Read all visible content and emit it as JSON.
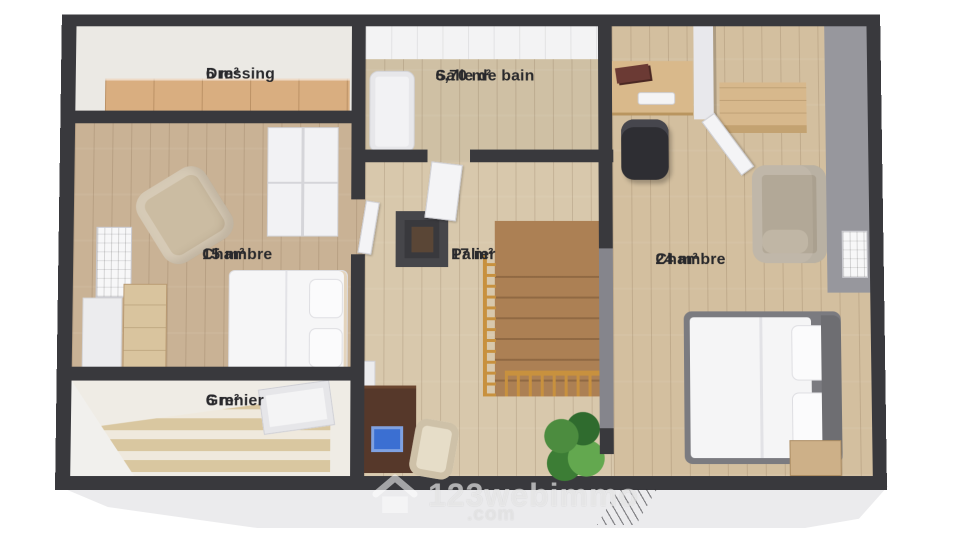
{
  "plan": {
    "rooms": [
      {
        "id": "dressing",
        "name": "Dressing",
        "area": "6 m²"
      },
      {
        "id": "salle-de-bain",
        "name": "Salle de bain",
        "area": "6,70 m²"
      },
      {
        "id": "chambre-15",
        "name": "Chambre",
        "area": "15 m²"
      },
      {
        "id": "palier",
        "name": "Palier",
        "area": "17 m²"
      },
      {
        "id": "chambre-24",
        "name": "Chambre",
        "area": "24 m²"
      },
      {
        "id": "grenier",
        "name": "Grenier",
        "area": "6 m²"
      }
    ]
  },
  "watermark": {
    "brand": "123webimmo",
    "tld": ".com",
    "icon": "house-icon"
  },
  "colors": {
    "wall": "#39393d",
    "wall_gray": "#85858c",
    "floor_wood": "#c9b295",
    "floor_palier": "#d8c8ac",
    "floor_ch24": "#d3bf9f",
    "floor_light": "#ebe9e4",
    "bath_wood": "#cfc0a4",
    "wardrobe_tan": "#d9ae80",
    "furniture_tan": "#d7b88c",
    "stairs": "#ac8054",
    "railing": "#c8913e",
    "desk_dark": "#56382a",
    "laptop_blue": "#3b6fd2",
    "plant_green": "#478a3d",
    "label_text": "#29292c",
    "base": "#ebebed",
    "white_furn": "#f2f2f4",
    "sofa": "#b2a897",
    "bed_frame": "#7b7b80",
    "chair_dark": "#2e2e33",
    "armchair": "#cbbca2"
  }
}
